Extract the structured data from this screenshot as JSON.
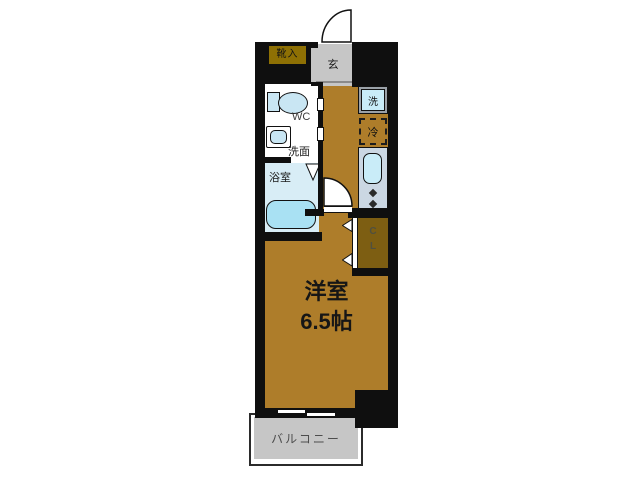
{
  "plan": {
    "main_room": {
      "name": "洋室",
      "size": "6.5帖"
    },
    "entrance": {
      "label": "玄"
    },
    "shoe_storage": {
      "label": "靴入"
    },
    "wc": {
      "label": "WC"
    },
    "washroom": {
      "label": "洗面"
    },
    "bathroom": {
      "label": "浴室"
    },
    "closet": {
      "letter_top": "C",
      "letter_bottom": "L"
    },
    "washing_machine": {
      "label": "洗"
    },
    "refrigerator": {
      "label": "冷"
    },
    "balcony": {
      "label": "バルコニー"
    }
  },
  "colors": {
    "wall": "#0f0f0f",
    "floor": "#ae7d2a",
    "closet_floor": "#7d5e12",
    "entrance_floor": "#c6c6c6",
    "balcony_floor": "#c6c6c6",
    "bath_floor": "#d8edf6",
    "fixture_cyan": "#c9ecf8",
    "tub_cyan": "#a9e1f3",
    "toilet_cyan": "#c9e6f3",
    "counter": "#cbd7e3",
    "shoe_box": "#8e7004"
  }
}
